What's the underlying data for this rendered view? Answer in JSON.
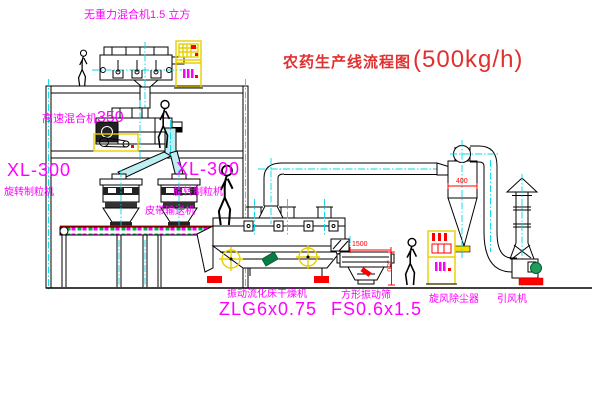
{
  "title": {
    "text": "农药生产线流程图",
    "capacity": "(500kg/h)"
  },
  "equipment": {
    "gravity_mixer": "无重力混合机1.5 立方",
    "high_speed_mixer": "高速混合机",
    "high_speed_mixer_size": "350",
    "granulator_left_model": "XL-300",
    "granulator_left_name": "旋转制粒机",
    "granulator_right_model": "XL-300",
    "granulator_right_name": "旋转制粒机",
    "belt_conveyor": "皮带输送机",
    "dryer_name": "振动流化床干燥机",
    "dryer_model": "ZLG6x0.75",
    "sieve_name": "方形振动筛",
    "sieve_model": "FS0.6x1.5",
    "cyclone_name": "旋风除尘器",
    "fan_name": "引风机"
  },
  "dimensions": {
    "sieve_length": "1500",
    "cyclone_width": "400",
    "sieve_height": "350"
  },
  "colors": {
    "label_magenta": "#ff00ff",
    "title_red": "#e03030",
    "dimension_red": "#ff0000",
    "cad_yellow": "#e8cf00",
    "centerline_cyan": "#00d9e8",
    "chute_cyan": "#bdeef2",
    "motor_green": "#1f9e5a",
    "belt_green": "#00b050",
    "background": "#ffffff"
  }
}
